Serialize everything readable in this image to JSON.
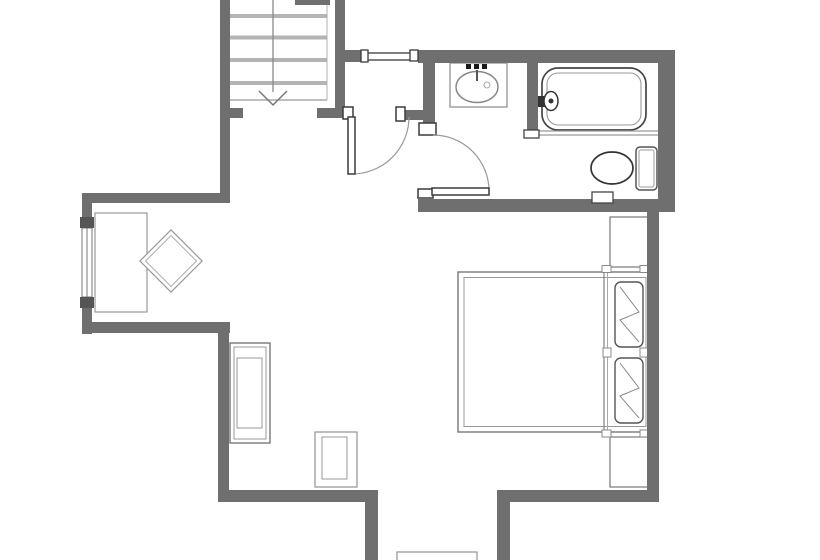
{
  "title": "apartment-floor-plan",
  "canvas": {
    "w": 820,
    "h": 560,
    "bg": "#ffffff"
  },
  "colors": {
    "wall": "#6f6f6f",
    "jamb_stroke": "#3a3a3a",
    "fixture_dark": "#444444",
    "fixture_mid": "#777777",
    "fixture_light": "#999999",
    "tread": "#b4b4b4",
    "fill": "#ffffff",
    "accent_dark": "#1a1a1a"
  },
  "groups": [
    {
      "name": "staircase",
      "items": [
        {
          "t": "rect",
          "n": "stair-tread-1",
          "x": 228,
          "y": 14,
          "w": 99,
          "h": 4,
          "f": "#b4b4b4"
        },
        {
          "t": "rect",
          "n": "stair-tread-2",
          "x": 228,
          "y": 35.5,
          "w": 99,
          "h": 4,
          "f": "#b4b4b4"
        },
        {
          "t": "rect",
          "n": "stair-tread-3",
          "x": 228,
          "y": 58,
          "w": 99,
          "h": 4,
          "f": "#b4b4b4"
        },
        {
          "t": "rect",
          "n": "stair-tread-4",
          "x": 228,
          "y": 81,
          "w": 99,
          "h": 4,
          "f": "#b4b4b4"
        },
        {
          "t": "line",
          "n": "stair-stringer-line",
          "x1": 327,
          "y1": 0,
          "x2": 327,
          "y2": 100,
          "s": "#b0b0b0",
          "sw": 1
        },
        {
          "t": "line",
          "n": "stair-landing-line",
          "x1": 228,
          "y1": 100,
          "x2": 327,
          "y2": 100,
          "s": "#999999",
          "sw": 1.3
        },
        {
          "t": "line",
          "n": "stair-direction-line",
          "x1": 273,
          "y1": 0,
          "x2": 273,
          "y2": 92,
          "s": "#8a8a8a",
          "sw": 1.3
        },
        {
          "t": "polyline",
          "n": "stair-direction-arrow",
          "p": "259,91 273,105 287,91",
          "s": "#777777",
          "sw": 1.5
        }
      ]
    },
    {
      "name": "windows",
      "items": [
        {
          "t": "rect",
          "n": "left-window",
          "x": 82,
          "y": 228,
          "w": 10,
          "h": 69,
          "f": "#ffffff",
          "s": "#777777",
          "sw": 1
        },
        {
          "t": "line",
          "n": "left-window-mullion",
          "x1": 87,
          "y1": 228,
          "x2": 87,
          "y2": 297,
          "s": "#777777",
          "sw": 1
        },
        {
          "t": "line",
          "n": "hall-passthrough-line-top",
          "x1": 367,
          "y1": 53,
          "x2": 411,
          "y2": 53,
          "s": "#555555",
          "sw": 1.5
        },
        {
          "t": "line",
          "n": "hall-passthrough-line-bottom",
          "x1": 367,
          "y1": 60,
          "x2": 411,
          "y2": 60,
          "s": "#555555",
          "sw": 1.5
        }
      ]
    },
    {
      "name": "living-area",
      "items": [
        {
          "t": "rect",
          "n": "desk",
          "x": 95,
          "y": 213,
          "w": 52,
          "h": 99,
          "f": "#ffffff",
          "s": "#999999",
          "sw": 1.2
        },
        {
          "t": "rect",
          "n": "chair-rotated-outer",
          "x": 149,
          "y": 239,
          "w": 44,
          "h": 44,
          "tf": "rotate(45 171 261)",
          "f": "#ffffff",
          "s": "#999999",
          "sw": 1.2
        },
        {
          "t": "rect",
          "n": "chair-rotated-inner",
          "x": 153,
          "y": 243,
          "w": 36,
          "h": 36,
          "tf": "rotate(45 171 261)",
          "s": "#aaaaaa",
          "sw": 1
        },
        {
          "t": "rect",
          "n": "armchair-outer",
          "x": 230,
          "y": 343,
          "w": 40,
          "h": 100,
          "f": "#ffffff",
          "s": "#777777",
          "sw": 1.4
        },
        {
          "t": "rect",
          "n": "armchair-inner",
          "x": 234,
          "y": 347,
          "w": 32,
          "h": 92,
          "s": "#999999",
          "sw": 1
        },
        {
          "t": "rect",
          "n": "armchair-seat",
          "x": 237,
          "y": 358,
          "w": 25,
          "h": 70,
          "s": "#999999",
          "sw": 1
        },
        {
          "t": "rect",
          "n": "side-stool-outer",
          "x": 315,
          "y": 432,
          "w": 42,
          "h": 55,
          "f": "#ffffff",
          "s": "#999999",
          "sw": 1.3
        },
        {
          "t": "rect",
          "n": "side-stool-inner",
          "x": 322,
          "y": 437,
          "w": 25,
          "h": 42,
          "s": "#999999",
          "sw": 1
        },
        {
          "t": "rect",
          "n": "entry-threshold",
          "x": 397,
          "y": 552,
          "w": 80,
          "h": 14,
          "f": "#ffffff",
          "s": "#999999",
          "sw": 1.3
        }
      ]
    },
    {
      "name": "bedroom",
      "items": [
        {
          "t": "rect",
          "n": "nightstand-top",
          "x": 610,
          "y": 217,
          "w": 38,
          "h": 50,
          "f": "#ffffff",
          "s": "#777777",
          "sw": 1.2
        },
        {
          "t": "rect",
          "n": "nightstand-bottom",
          "x": 610,
          "y": 437,
          "w": 38,
          "h": 50,
          "f": "#ffffff",
          "s": "#777777",
          "sw": 1.2
        },
        {
          "t": "rect",
          "n": "bed-frame",
          "x": 458,
          "y": 272,
          "w": 192,
          "h": 160,
          "f": "#ffffff",
          "s": "#777777",
          "sw": 1.4
        },
        {
          "t": "rect",
          "n": "bed-mattress",
          "x": 464,
          "y": 277.5,
          "w": 182,
          "h": 149,
          "s": "#999999",
          "sw": 1
        },
        {
          "t": "line",
          "n": "bed-headboard-line-1",
          "x1": 604,
          "y1": 272,
          "x2": 604,
          "y2": 432,
          "s": "#777777",
          "sw": 1.1
        },
        {
          "t": "line",
          "n": "bed-headboard-line-2",
          "x1": 607.5,
          "y1": 272,
          "x2": 607.5,
          "y2": 432,
          "s": "#aaaaaa",
          "sw": 1
        },
        {
          "t": "rect",
          "n": "bed-tick-top-left",
          "x": 602,
          "y": 265.5,
          "w": 9,
          "h": 7,
          "f": "#ffffff",
          "s": "#888888",
          "sw": 1
        },
        {
          "t": "rect",
          "n": "bed-tick-top-right",
          "x": 640,
          "y": 265.5,
          "w": 9,
          "h": 7,
          "f": "#ffffff",
          "s": "#888888",
          "sw": 1
        },
        {
          "t": "rect",
          "n": "bed-tick-mid-left",
          "x": 603,
          "y": 348,
          "w": 8,
          "h": 9,
          "f": "#ffffff",
          "s": "#888888",
          "sw": 1
        },
        {
          "t": "rect",
          "n": "bed-tick-mid-right",
          "x": 640,
          "y": 348,
          "w": 8,
          "h": 9,
          "f": "#ffffff",
          "s": "#888888",
          "sw": 1
        },
        {
          "t": "rect",
          "n": "bed-tick-bottom-left",
          "x": 602,
          "y": 430,
          "w": 9,
          "h": 7,
          "f": "#ffffff",
          "s": "#888888",
          "sw": 1
        },
        {
          "t": "rect",
          "n": "bed-tick-bottom-right",
          "x": 640,
          "y": 430,
          "w": 9,
          "h": 7,
          "f": "#ffffff",
          "s": "#888888",
          "sw": 1
        },
        {
          "t": "rect",
          "n": "pillow-1-outline",
          "x": 615,
          "y": 282,
          "w": 28,
          "h": 65,
          "rx": 6,
          "f": "#ffffff",
          "s": "#555555",
          "sw": 1.4
        },
        {
          "t": "polyline",
          "n": "pillow-1-folds",
          "p": "620,287 639,312 620,320 639,342",
          "s": "#888888",
          "sw": 1
        },
        {
          "t": "rect",
          "n": "pillow-2-outline",
          "x": 615,
          "y": 358,
          "w": 28,
          "h": 65,
          "rx": 6,
          "f": "#ffffff",
          "s": "#555555",
          "sw": 1.4
        },
        {
          "t": "polyline",
          "n": "pillow-2-folds",
          "p": "620,363 639,388 620,396 639,418",
          "s": "#888888",
          "sw": 1
        }
      ]
    },
    {
      "name": "bathroom",
      "items": [
        {
          "t": "rect",
          "n": "sink-counter",
          "x": 450,
          "y": 63,
          "w": 57,
          "h": 44,
          "f": "#ffffff",
          "s": "#999999",
          "sw": 1.4
        },
        {
          "t": "ellipse",
          "n": "sink-basin",
          "cx": 477,
          "cy": 87,
          "rx": 21,
          "ry": 15.5,
          "f": "#ffffff",
          "s": "#888888",
          "sw": 1.5
        },
        {
          "t": "circle",
          "n": "sink-drain",
          "cx": 487,
          "cy": 85,
          "r": 3,
          "s": "#aaaaaa",
          "sw": 1
        },
        {
          "t": "rect",
          "n": "sink-faucet-dot-1",
          "x": 466,
          "y": 64,
          "w": 5,
          "h": 5,
          "f": "#1a1a1a"
        },
        {
          "t": "rect",
          "n": "sink-faucet-dot-2",
          "x": 474,
          "y": 64,
          "w": 5,
          "h": 5,
          "f": "#1a1a1a"
        },
        {
          "t": "rect",
          "n": "sink-faucet-dot-3",
          "x": 482,
          "y": 64,
          "w": 5,
          "h": 5,
          "f": "#1a1a1a"
        },
        {
          "t": "line",
          "n": "sink-faucet-spout",
          "x1": 477,
          "y1": 70,
          "x2": 477,
          "y2": 81,
          "s": "#555555",
          "sw": 2
        },
        {
          "t": "rect",
          "n": "bathtub-outer",
          "x": 542,
          "y": 68,
          "w": 104,
          "h": 62,
          "rx": 16,
          "f": "#ffffff",
          "s": "#444444",
          "sw": 1.7
        },
        {
          "t": "rect",
          "n": "bathtub-inner",
          "x": 547,
          "y": 73,
          "w": 94,
          "h": 52,
          "rx": 11,
          "s": "#999999",
          "sw": 1.1
        },
        {
          "t": "line",
          "n": "tub-ledge-line-top",
          "x1": 538,
          "y1": 131,
          "x2": 658,
          "y2": 131,
          "s": "#999999",
          "sw": 1.2
        },
        {
          "t": "line",
          "n": "tub-ledge-line-bottom",
          "x1": 538,
          "y1": 135,
          "x2": 658,
          "y2": 135,
          "s": "#999999",
          "sw": 1.2
        },
        {
          "t": "rect",
          "n": "tub-faucet-base",
          "x": 536,
          "y": 96,
          "w": 9,
          "h": 11,
          "f": "#333333"
        },
        {
          "t": "ellipse",
          "n": "tub-faucet-knob",
          "cx": 551,
          "cy": 101,
          "rx": 7,
          "ry": 9.5,
          "f": "#ffffff",
          "s": "#333333",
          "sw": 1.5
        },
        {
          "t": "circle",
          "n": "tub-faucet-dot",
          "cx": 551,
          "cy": 101,
          "r": 2.5,
          "f": "#333333"
        },
        {
          "t": "rect",
          "n": "toilet-tank",
          "x": 636,
          "y": 147,
          "w": 21,
          "h": 43,
          "rx": 4,
          "f": "#ffffff",
          "s": "#555555",
          "sw": 1.5
        },
        {
          "t": "rect",
          "n": "toilet-tank-inner",
          "x": 639,
          "y": 150,
          "w": 15,
          "h": 37,
          "rx": 2,
          "s": "#999999",
          "sw": 1
        },
        {
          "t": "ellipse",
          "n": "toilet-bowl",
          "cx": 612,
          "cy": 168,
          "rx": 21,
          "ry": 16,
          "f": "#ffffff",
          "s": "#333333",
          "sw": 1.7
        }
      ]
    },
    {
      "name": "walls",
      "items": [
        {
          "t": "rect",
          "n": "stair-left-wall",
          "x": 220,
          "y": 0,
          "w": 10,
          "h": 203,
          "f": "#6f6f6f"
        },
        {
          "t": "rect",
          "n": "stair-right-wall",
          "x": 335,
          "y": 0,
          "w": 10,
          "h": 118,
          "f": "#6f6f6f"
        },
        {
          "t": "rect",
          "n": "stair-top-stub-wall",
          "x": 295,
          "y": 0,
          "w": 35,
          "h": 5,
          "f": "#6f6f6f"
        },
        {
          "t": "rect",
          "n": "hall-passthrough-stub-wall",
          "x": 345,
          "y": 50,
          "w": 18,
          "h": 12,
          "f": "#6f6f6f"
        },
        {
          "t": "rect",
          "n": "alcove-top-wall",
          "x": 82,
          "y": 193,
          "w": 148,
          "h": 10,
          "f": "#6f6f6f"
        },
        {
          "t": "rect",
          "n": "left-wall-upper",
          "x": 82,
          "y": 203,
          "w": 10,
          "h": 16,
          "f": "#6f6f6f"
        },
        {
          "t": "rect",
          "n": "window-jamb-top",
          "x": 80,
          "y": 217,
          "w": 14,
          "h": 11,
          "f": "#555555"
        },
        {
          "t": "rect",
          "n": "window-jamb-bottom",
          "x": 80,
          "y": 297,
          "w": 14,
          "h": 11,
          "f": "#555555"
        },
        {
          "t": "rect",
          "n": "left-wall-lower",
          "x": 82,
          "y": 308,
          "w": 10,
          "h": 26,
          "f": "#6f6f6f"
        },
        {
          "t": "rect",
          "n": "alcove-bottom-wall",
          "x": 82,
          "y": 322,
          "w": 148,
          "h": 11,
          "f": "#6f6f6f"
        },
        {
          "t": "rect",
          "n": "left-mid-wall",
          "x": 218,
          "y": 330,
          "w": 11,
          "h": 172,
          "f": "#6f6f6f"
        },
        {
          "t": "rect",
          "n": "room-bottom-left-wall",
          "x": 218,
          "y": 490,
          "w": 160,
          "h": 12,
          "f": "#6f6f6f"
        },
        {
          "t": "rect",
          "n": "opening-left-wall",
          "x": 365,
          "y": 490,
          "w": 13,
          "h": 70,
          "f": "#6f6f6f"
        },
        {
          "t": "rect",
          "n": "opening-right-wall",
          "x": 497,
          "y": 490,
          "w": 13,
          "h": 70,
          "f": "#6f6f6f"
        },
        {
          "t": "rect",
          "n": "room-bottom-right-wall",
          "x": 497,
          "y": 490,
          "w": 162,
          "h": 12,
          "f": "#6f6f6f"
        },
        {
          "t": "rect",
          "n": "bedroom-right-wall",
          "x": 647,
          "y": 205,
          "w": 12,
          "h": 297,
          "f": "#6f6f6f"
        },
        {
          "t": "rect",
          "n": "bathroom-right-wall",
          "x": 658,
          "y": 50,
          "w": 17,
          "h": 162,
          "f": "#6f6f6f"
        },
        {
          "t": "rect",
          "n": "bathroom-top-wall",
          "x": 418,
          "y": 50,
          "w": 257,
          "h": 13,
          "f": "#6f6f6f"
        },
        {
          "t": "rect",
          "n": "bathroom-left-wall",
          "x": 423,
          "y": 53,
          "w": 12,
          "h": 72,
          "f": "#6f6f6f"
        },
        {
          "t": "rect",
          "n": "hall-stub-wall-left",
          "x": 230,
          "y": 108,
          "w": 13,
          "h": 10,
          "f": "#6f6f6f"
        },
        {
          "t": "rect",
          "n": "hall-stub-wall-right",
          "x": 317,
          "y": 108,
          "w": 28,
          "h": 10,
          "f": "#6f6f6f"
        },
        {
          "t": "rect",
          "n": "hall-stub-wall-bathroom",
          "x": 402,
          "y": 110,
          "w": 21,
          "h": 10,
          "f": "#6f6f6f"
        },
        {
          "t": "rect",
          "n": "bathroom-bottom-wall",
          "x": 418,
          "y": 199,
          "w": 257,
          "h": 13,
          "f": "#6f6f6f"
        },
        {
          "t": "rect",
          "n": "tub-partition-wall",
          "x": 527,
          "y": 60,
          "w": 11,
          "h": 77,
          "f": "#6f6f6f"
        }
      ]
    },
    {
      "name": "jambs",
      "items": [
        {
          "t": "rect",
          "n": "hall-door-jamb-left",
          "x": 343,
          "y": 107,
          "w": 10,
          "h": 12,
          "f": "#ffffff",
          "s": "#3a3a3a",
          "sw": 1.5
        },
        {
          "t": "rect",
          "n": "hall-door-jamb-right",
          "x": 396,
          "y": 107,
          "w": 9,
          "h": 14,
          "f": "#ffffff",
          "s": "#3a3a3a",
          "sw": 1.5
        },
        {
          "t": "rect",
          "n": "passthrough-cap-left",
          "x": 361,
          "y": 50,
          "w": 7,
          "h": 12,
          "f": "#ffffff",
          "s": "#3a3a3a",
          "sw": 1.3
        },
        {
          "t": "rect",
          "n": "passthrough-cap-right",
          "x": 410,
          "y": 50,
          "w": 8,
          "h": 11,
          "f": "#ffffff",
          "s": "#3a3a3a",
          "sw": 1.3
        },
        {
          "t": "rect",
          "n": "bath-door-jamb-top",
          "x": 419,
          "y": 123,
          "w": 17,
          "h": 12,
          "f": "#ffffff",
          "s": "#3a3a3a",
          "sw": 1.5
        },
        {
          "t": "rect",
          "n": "bath-door-jamb-bottom",
          "x": 418,
          "y": 189,
          "w": 15,
          "h": 9,
          "f": "#ffffff",
          "s": "#3a3a3a",
          "sw": 1.5
        },
        {
          "t": "rect",
          "n": "tub-partition-cap",
          "x": 524,
          "y": 130,
          "w": 15,
          "h": 8,
          "f": "#ffffff",
          "s": "#444444",
          "sw": 1.3
        },
        {
          "t": "rect",
          "n": "bathroom-wall-niche",
          "x": 592,
          "y": 192,
          "w": 21,
          "h": 11,
          "f": "#ffffff",
          "s": "#444444",
          "sw": 1.3
        }
      ]
    },
    {
      "name": "doors",
      "items": [
        {
          "t": "path",
          "n": "hall-door-swing-arc",
          "d": "M352,174 A57,57 0 0 0 409,117",
          "s": "#999999",
          "sw": 1.2
        },
        {
          "t": "rect",
          "n": "hall-door-leaf",
          "x": 348,
          "y": 117,
          "w": 7,
          "h": 57,
          "f": "#ffffff",
          "s": "#3a3a3a",
          "sw": 1.5
        },
        {
          "t": "path",
          "n": "bath-door-swing-arc",
          "d": "M433,135 A56,56 0 0 1 489,191",
          "s": "#999999",
          "sw": 1.2
        },
        {
          "t": "rect",
          "n": "bath-door-leaf",
          "x": 432,
          "y": 188,
          "w": 57,
          "h": 7,
          "f": "#ffffff",
          "s": "#3a3a3a",
          "sw": 1.5
        }
      ]
    }
  ]
}
